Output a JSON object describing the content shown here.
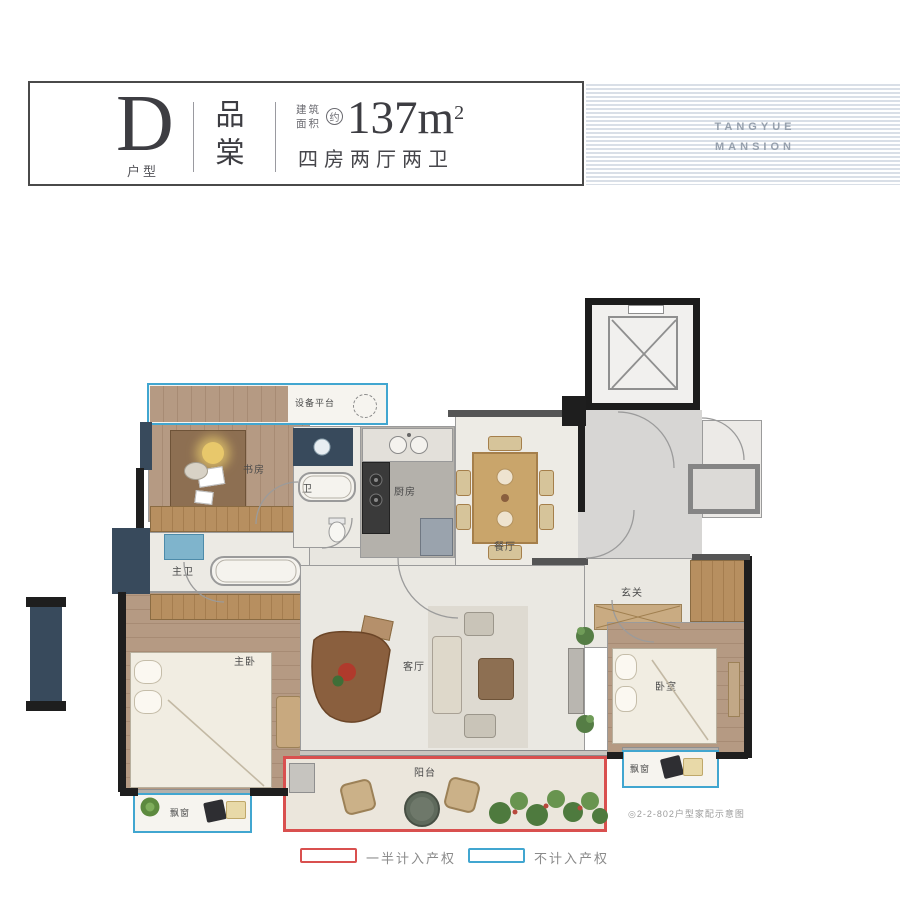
{
  "header": {
    "type_letter": "D",
    "type_suffix": "户型",
    "brand": "品棠",
    "area_label_1": "建筑",
    "area_label_2": "面积",
    "area_approx": "约",
    "area_value": "137m",
    "area_exponent": "2",
    "spec": "四房两厅两卫"
  },
  "banner": {
    "line1": "TANGYUE",
    "line2": "MANSION"
  },
  "floorplan": {
    "rooms": {
      "equipment_platform": "设备平台",
      "study": "书房",
      "bath": "卫",
      "kitchen": "厨房",
      "dining": "餐厅",
      "master_bath": "主卫",
      "master_bedroom": "主卧",
      "living": "客厅",
      "foyer": "玄关",
      "bedroom": "卧室",
      "balcony": "阳台",
      "bay_window_left": "飘窗",
      "bay_window_right": "飘窗"
    },
    "caption": "◎2-2-802户型家配示意图"
  },
  "legend": {
    "half_counted": "一半计入产权",
    "not_counted": "不计入产权",
    "red": "#d9504f",
    "blue": "#41a6d0"
  }
}
